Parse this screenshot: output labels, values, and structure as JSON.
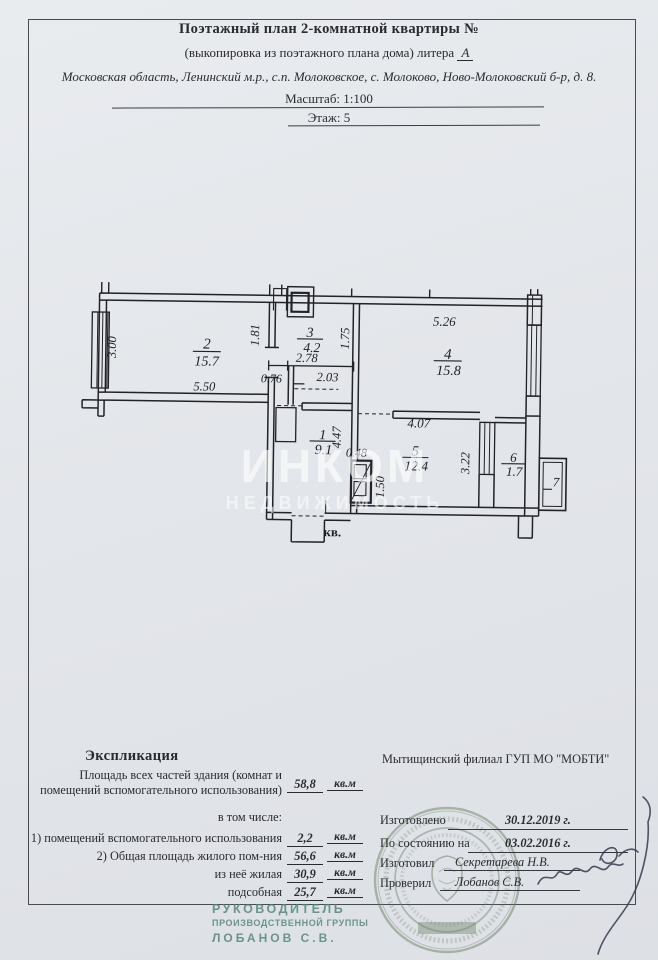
{
  "colors": {
    "page_bg": "#e3e6ea",
    "ink": "#2a2a30",
    "seal_green": "#6e8068",
    "stamp_teal": "#4f8075",
    "watermark": "#ffffff"
  },
  "header": {
    "title": "Поэтажный план  2-комнатной квартиры №",
    "subtitle_prefix": "(выкопировка из поэтажного плана дома) литера",
    "litera": "А",
    "address": "Московская область, Ленинский м.р., с.п. Молоковское, с. Молоково, Ново-Молоковский б-р, д. 8.",
    "scale": "Масштаб: 1:100",
    "floor": "Этаж: 5"
  },
  "plan": {
    "rooms": {
      "r1": {
        "num": "1",
        "area": "9.1"
      },
      "r2": {
        "num": "2",
        "area": "15.7"
      },
      "r3": {
        "num": "3",
        "area": "4.2"
      },
      "r4": {
        "num": "4",
        "area": "15.8"
      },
      "r5": {
        "num": "5",
        "area": "12.4"
      },
      "r6": {
        "num": "6",
        "area": "1.7"
      },
      "r7": {
        "num": "7"
      }
    },
    "dims": {
      "left_height": "3.00",
      "room2_width": "5.50",
      "d181": "1.81",
      "d278": "2.78",
      "d076": "0.76",
      "d203": "2.03",
      "d175": "1.75",
      "room4_width": "5.26",
      "hall_length": "4.47",
      "d048": "0.48",
      "d150": "1.50",
      "room5_width": "4.07",
      "d322": "3.22"
    },
    "entrance_label": "кв."
  },
  "watermark": {
    "line1": "ИНКОМ",
    "line2": "НЕДВИЖИМОСТЬ"
  },
  "explication": {
    "heading": "Экспликация",
    "total": {
      "label": "Площадь всех частей здания (комнат и помещений вспомогательного использования)",
      "value": "58,8",
      "unit": "кв.м"
    },
    "including": "в том числе:",
    "rows": [
      {
        "label": "1) помещений вспомогательного использования",
        "value": "2,2",
        "unit": "кв.м"
      },
      {
        "label": "2) Общая площадь жилого пом-ния",
        "value": "56,6",
        "unit": "кв.м"
      },
      {
        "label": "из неё жилая",
        "value": "30,9",
        "unit": "кв.м"
      },
      {
        "label": "подсобная",
        "value": "25,7",
        "unit": "кв.м"
      }
    ]
  },
  "office": {
    "name": "Мытищинский филиал ГУП МО \"МОБТИ\""
  },
  "signatures": {
    "made_label": "Изготовлено",
    "made_value": "30.12.2019 г.",
    "asof_label": "По состоянию на",
    "asof_value": "03.02.2016 г.",
    "author_label": "Изготовил",
    "author_value": "Секретарева Н.В.",
    "checker_label": "Проверил",
    "checker_value": "Лобанов С.В."
  },
  "stamp": {
    "line1": "РУКОВОДИТЕЛЬ",
    "line2": "ПРОИЗВОДСТВЕННОЙ ГРУППЫ",
    "line3": "ЛОБАНОВ С.В."
  }
}
